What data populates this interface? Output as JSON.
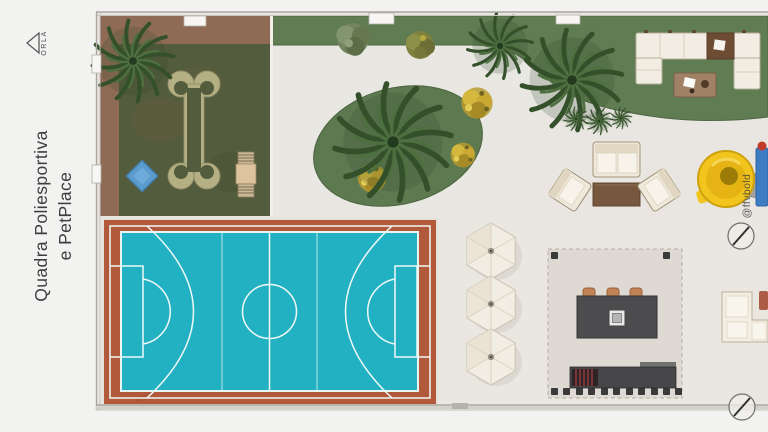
{
  "page": {
    "background_color": "#f2f2f1"
  },
  "sidebar": {
    "logo": {
      "brand_text": "ORLA",
      "icon": "roof-triangle-icon"
    },
    "title": {
      "line1": "Quadra Poliesportiva",
      "line2": "e PetPlace"
    }
  },
  "plan": {
    "watermark_handle": "@ffvbold",
    "colors": {
      "paving": "#e9e6e1",
      "lawn_green": "#5f7c52",
      "bed_green": "#5d7950",
      "pet_grass": "#535c3c",
      "wood_deck_brown": "#8f6b55",
      "bone_path_tan": "#b5b084",
      "court_terracotta": "#b2593c",
      "court_cyan": "#22b1c3",
      "court_line_white": "#eef8f7",
      "umbrella_white": "#f2ede3",
      "bar_counter_gray": "#4c4c4e",
      "stool_orange": "#c28356",
      "slide_yellow": "#f2c51e",
      "pool_blue_diamond": "#5b9ccf",
      "sofa_white": "#f1ede2"
    }
  }
}
